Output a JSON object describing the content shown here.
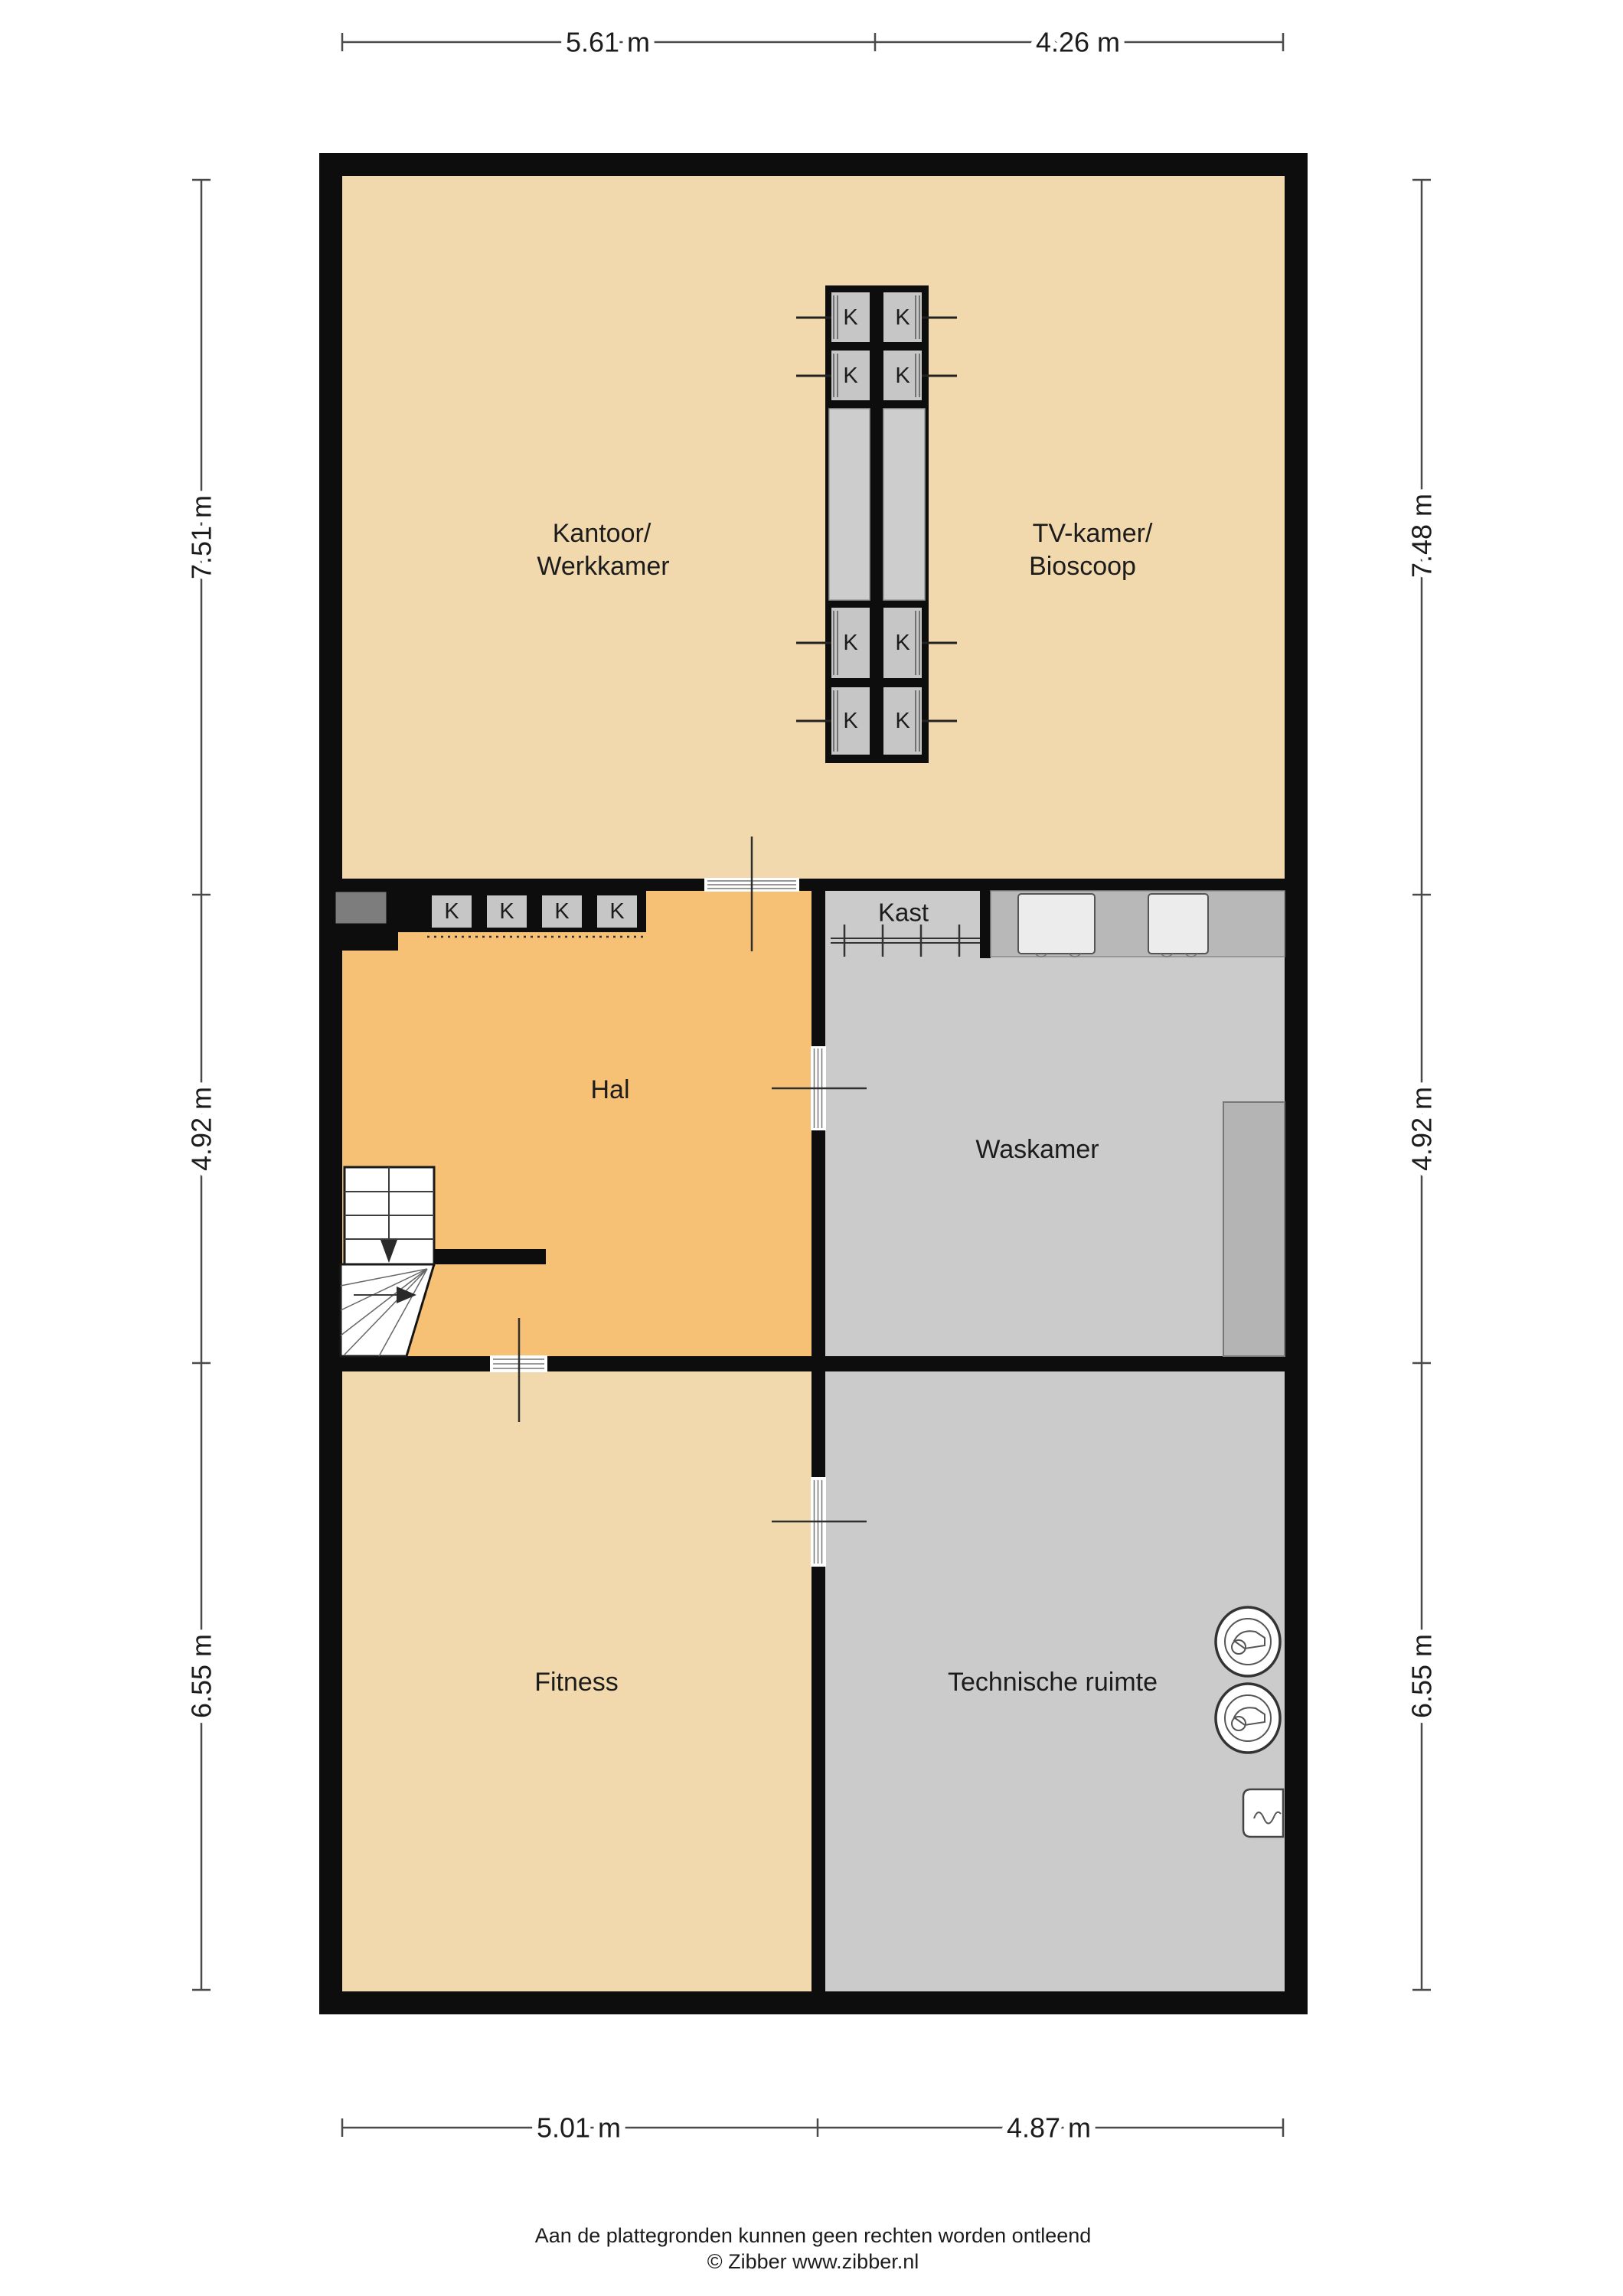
{
  "labels": {
    "kantoor_line1": "Kantoor/",
    "kantoor_line2": "Werkkamer",
    "tv_line1": "TV-kamer/",
    "tv_line2": "Bioscoop",
    "hal": "Hal",
    "kast": "Kast",
    "waskamer": "Waskamer",
    "fitness": "Fitness",
    "technische": "Technische ruimte",
    "k": "K"
  },
  "dimensions": {
    "top": [
      "5.61 m",
      "4.26 m"
    ],
    "bottom": [
      "5.01 m",
      "4.87 m"
    ],
    "left": [
      "7.51 m",
      "4.92 m",
      "6.55 m"
    ],
    "right": [
      "7.48 m",
      "4.92 m",
      "6.55 m"
    ]
  },
  "footer": {
    "disclaimer": "Aan de plattegronden kunnen geen rechten worden ontleend",
    "copyright": "© Zibber www.zibber.nl"
  },
  "colors": {
    "wall": "#0d0d0d",
    "beige": "#f1d9ad",
    "orange": "#f6c175",
    "roomgray": "#cbcbcb",
    "cellgray": "#c6c6c6",
    "tallgray": "#cdcdcd",
    "niche": "#b8b8b8",
    "counter": "#b4b4b4",
    "duct": "#7d7d7d",
    "appliance": "#ececec",
    "dim": "#4a4a4a",
    "ink": "#1c1c1c"
  }
}
